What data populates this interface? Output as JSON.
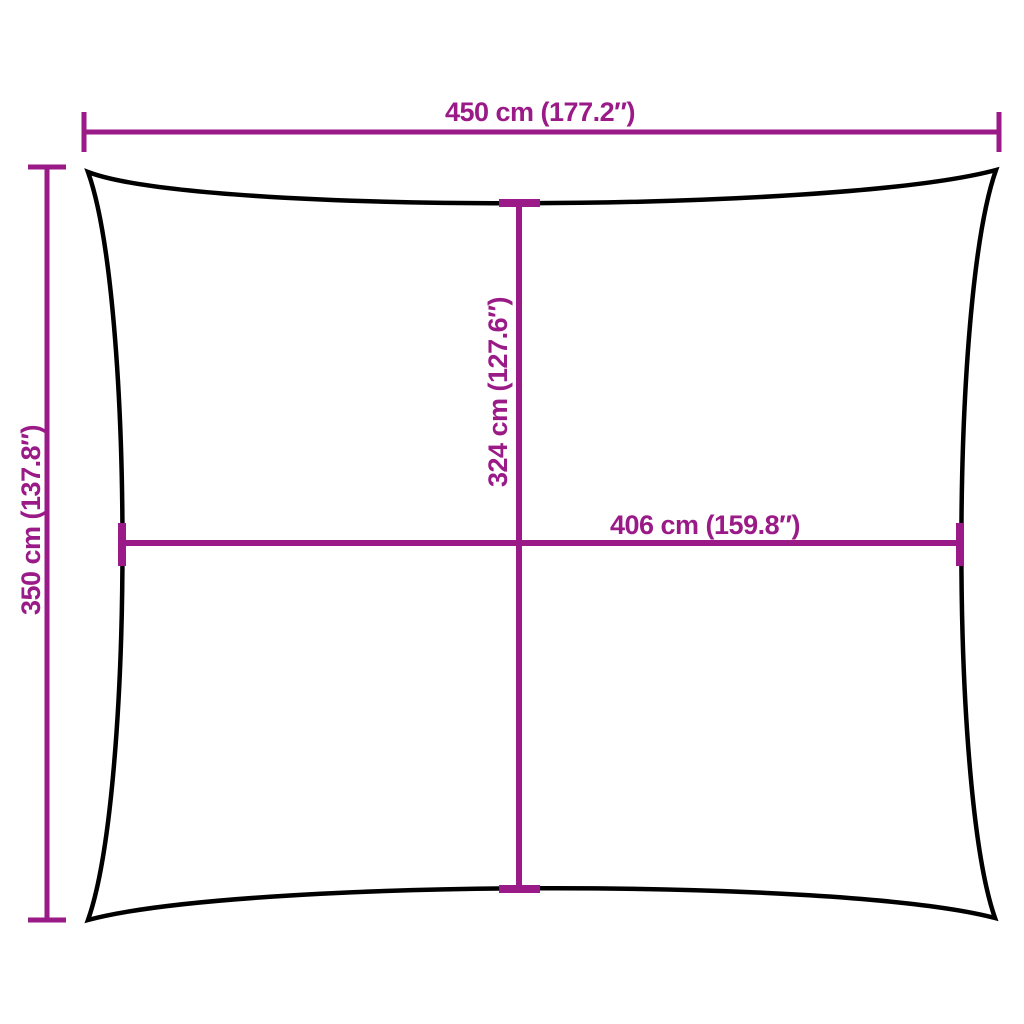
{
  "diagram": {
    "colors": {
      "dimension": "#9a1a87",
      "outline": "#000000",
      "background": "#ffffff"
    },
    "dimensions": {
      "top_width": {
        "label": "450 cm (177.2″)",
        "value_cm": 450,
        "value_inch": 177.2
      },
      "side_height": {
        "label": "350 cm (137.8″)",
        "value_cm": 350,
        "value_inch": 137.8
      },
      "center_height": {
        "label": "324 cm (127.6″)",
        "value_cm": 324,
        "value_inch": 127.6
      },
      "center_width": {
        "label": "406 cm (159.8″)",
        "value_cm": 406,
        "value_inch": 159.8
      }
    }
  }
}
